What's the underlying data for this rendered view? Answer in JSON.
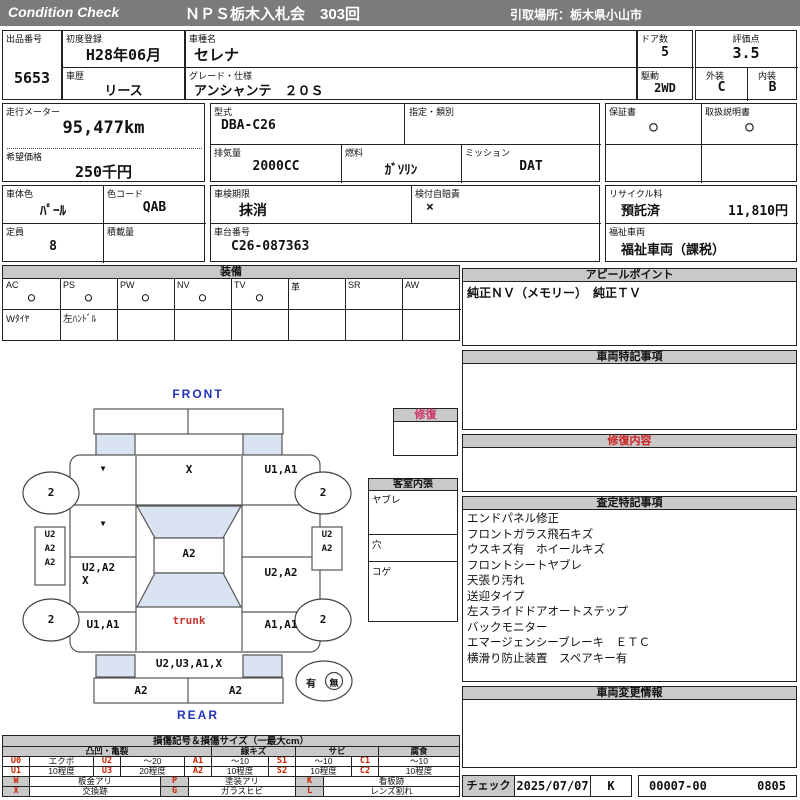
{
  "header": {
    "brand": "Condition  Check",
    "title": "ＮＰＳ栃木入札会　303回",
    "pickup": "引取場所：栃木県小山市"
  },
  "info": {
    "lot": {
      "label": "出品番号",
      "value": "5653"
    },
    "first_reg": {
      "label": "初度登録",
      "value": "H28年06月"
    },
    "history": {
      "label": "車歴",
      "value": "リース"
    },
    "model": {
      "label": "車種名",
      "value": "セレナ"
    },
    "grade": {
      "label": "グレード・仕様",
      "value": "アンシャンテ　２０Ｓ"
    },
    "doors": {
      "label": "ドア数",
      "value": "5"
    },
    "rating": {
      "label": "評価点",
      "value": "3.5"
    },
    "drive": {
      "label": "駆動",
      "value": "2WD"
    },
    "exterior": {
      "label": "外装",
      "value": "C"
    },
    "interior": {
      "label": "内装",
      "value": "B"
    },
    "mileage": {
      "label": "走行メーター",
      "value": "95,477km"
    },
    "price": {
      "label": "希望価格",
      "value": "250千円"
    },
    "model_code": {
      "label": "型式",
      "value": "DBA-C26"
    },
    "designation": {
      "label": "指定・類別",
      "value": ""
    },
    "displacement": {
      "label": "排気量",
      "value": "2000CC"
    },
    "fuel": {
      "label": "燃料",
      "value": "ｶﾞｿﾘﾝ"
    },
    "mission": {
      "label": "ミッション",
      "value": "DAT"
    },
    "warranty": {
      "label": "保証書",
      "value": "○"
    },
    "manual": {
      "label": "取扱説明書",
      "value": "○"
    },
    "body_color": {
      "label": "車体色",
      "value": "ﾊﾟｰﾙ"
    },
    "color_code": {
      "label": "色コード",
      "value": "QAB"
    },
    "inspection": {
      "label": "車検期限",
      "value": "抹消"
    },
    "insurance": {
      "label": "検付自賠責",
      "value": "×"
    },
    "recycle": {
      "label": "リサイクル料",
      "status": "預託済",
      "fee": "11,810円"
    },
    "capacity": {
      "label": "定員",
      "value": "8"
    },
    "load": {
      "label": "積載量",
      "value": ""
    },
    "chassis": {
      "label": "車台番号",
      "value": "C26-087363"
    },
    "welfare": {
      "label": "福祉車両",
      "value": "福祉車両（課税）"
    }
  },
  "equipment": {
    "title": "装備",
    "items": [
      {
        "label": "AC",
        "mark": "○",
        "note": "Wﾀｲﾔ"
      },
      {
        "label": "PS",
        "mark": "○",
        "note": "左ﾊﾝﾄﾞﾙ"
      },
      {
        "label": "PW",
        "mark": "○",
        "note": ""
      },
      {
        "label": "NV",
        "mark": "○",
        "note": ""
      },
      {
        "label": "TV",
        "mark": "○",
        "note": ""
      },
      {
        "label": "革",
        "mark": "",
        "note": ""
      },
      {
        "label": "SR",
        "mark": "",
        "note": ""
      },
      {
        "label": "AW",
        "mark": "",
        "note": ""
      }
    ]
  },
  "sections": {
    "appeal": {
      "title": "アピールポイント",
      "content": "純正ＮＶ（メモリー）　純正ＴＶ"
    },
    "special": {
      "title": "車両特記事項",
      "content": ""
    },
    "repair": {
      "title": "修復内容",
      "content": ""
    },
    "assessment": {
      "title": "査定特記事項",
      "items": [
        "エンドパネル修正",
        "フロントガラス飛石キズ",
        "ウスキズ有　ホイールキズ",
        "フロントシートヤブレ",
        "天張り汚れ",
        "送迎タイプ",
        "左スライドドアオートステップ",
        "バックモニター",
        "エマージェンシーブレーキ　ＥＴＣ",
        "横滑り防止装置　スペアキー有"
      ]
    },
    "changes": {
      "title": "車両変更情報",
      "content": ""
    }
  },
  "diagram": {
    "front_label": "FRONT",
    "rear_label": "REAR",
    "trunk_label": "trunk",
    "repair_box_title": "修復",
    "cabin": {
      "title": "客室内張",
      "rows": [
        "ヤブレ",
        "穴",
        "コゲ"
      ]
    },
    "wheel_mark": "2",
    "spare": {
      "yes": "有",
      "no": "無"
    },
    "sill_left": [
      "U2",
      "A2",
      "A2"
    ],
    "sill_right": [
      "U2",
      "A2"
    ],
    "marks": {
      "front_left_fender": "▼",
      "hood": "X",
      "front_right_fender": "U1,A1",
      "left_front_door": "▼",
      "roof": "A2",
      "left_slide_door_1": "U2,A2",
      "left_slide_door_2": "X",
      "right_slide_door": "U2,A2",
      "left_quarter": "U1,A1",
      "right_quarter": "A1,A1",
      "rear_panel": "U2,U3,A1,X",
      "rear_bumper_left": "A2",
      "rear_bumper_right": "A2"
    }
  },
  "legend": {
    "title": "損傷記号＆損傷サイズ（一最大cm）",
    "groups": [
      "凸凹・亀裂",
      "線キズ",
      "サビ",
      "腐食"
    ],
    "rows_small": [
      [
        {
          "c": "U0",
          "l": "エクボ"
        },
        {
          "c": "U2",
          "l": "〜20"
        },
        {
          "c": "A1",
          "l": "〜10"
        },
        {
          "c": "S1",
          "l": "〜10"
        },
        {
          "c": "C1",
          "l": "〜10"
        }
      ],
      [
        {
          "c": "U1",
          "l": "10程度"
        },
        {
          "c": "U3",
          "l": "20程度"
        },
        {
          "c": "A2",
          "l": "10程度"
        },
        {
          "c": "S2",
          "l": "10程度"
        },
        {
          "c": "C2",
          "l": "10程度"
        }
      ]
    ],
    "rows_wide": [
      [
        {
          "c": "W",
          "l": "板金アリ"
        },
        {
          "c": "P",
          "l": "塗装アリ"
        },
        {
          "c": "K",
          "l": "看板跡"
        }
      ],
      [
        {
          "c": "X",
          "l": "交換跡"
        },
        {
          "c": "G",
          "l": "ガラスヒビ"
        },
        {
          "c": "L",
          "l": "レンズ割れ"
        }
      ]
    ]
  },
  "check": {
    "label": "チェック",
    "date": "2025/07/07",
    "sign": "K",
    "code": "00007-00",
    "num": "0805"
  },
  "colors": {
    "accent_red": "#cc2222",
    "accent_blue": "#2233bb",
    "accent_pink": "#cc3366",
    "header_gray": "#7b7b7b",
    "section_gray": "#c9c9c9",
    "window_blue": "#d9e3f1"
  }
}
